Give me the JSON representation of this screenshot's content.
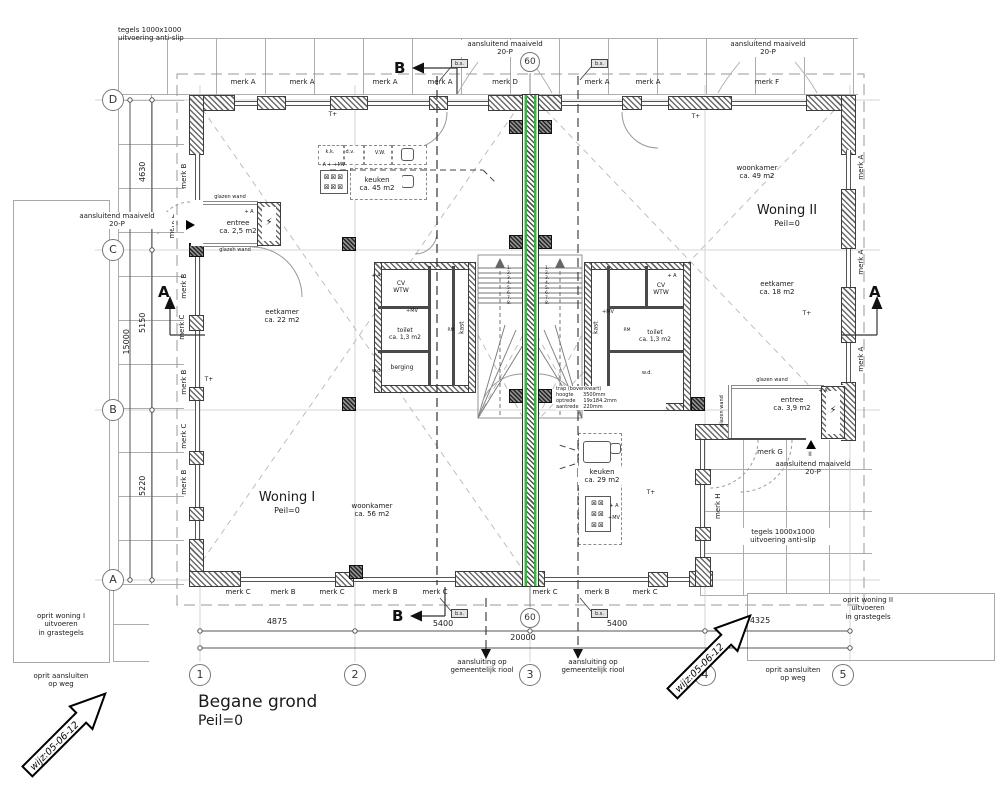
{
  "title": {
    "name": "Begane grond",
    "level": "Peil=0"
  },
  "grid": {
    "rows": [
      "D",
      "C",
      "B",
      "A"
    ],
    "cols": [
      "1",
      "2",
      "3",
      "4",
      "5"
    ],
    "bubble60": "60"
  },
  "dims": {
    "left": [
      "4630",
      "5150",
      "5220"
    ],
    "left_total": "15000",
    "bottom": [
      "4875",
      "5400",
      "5400",
      "4325"
    ],
    "bottom_total": "20000"
  },
  "marks": {
    "a": "merk A",
    "b": "merk B",
    "c": "merk C",
    "d": "merk D",
    "e": "merk E",
    "f": "merk F",
    "g": "merk G",
    "h": "merk H"
  },
  "sections": {
    "a": "A",
    "b": "B"
  },
  "units": {
    "woning1": {
      "name": "Woning I",
      "level": "Peil=0"
    },
    "woning2": {
      "name": "Woning II",
      "level": "Peil=0"
    }
  },
  "rooms": {
    "entree1": "entree\nca. 2,5 m2",
    "entree2": "entree\nca. 3,9 m2",
    "keuken1": "keuken\nca. 45 m2",
    "keuken2": "keuken\nca. 29 m2",
    "eetkamer1": "eetkamer\nca. 22 m2",
    "eetkamer2": "eetkamer\nca. 18 m2",
    "woonkamer1": "woonkamer\nca. 56 m2",
    "woonkamer2": "woonkamer\nca. 49 m2",
    "toilet1": "toilet\nca. 1,3 m2",
    "toilet2": "toilet\nca. 1,3 m2",
    "berging": "berging",
    "kast": "kast",
    "cv": "CV\nWTW"
  },
  "stair": {
    "note": "trap (bovenkwart)\nhoogte      3500mm\noptrede     19x184.2mm\naantrede   220mm",
    "treads": [
      "1.",
      "2.",
      "3.",
      "4.",
      "5.",
      "6.",
      "7.",
      "8."
    ]
  },
  "notes": {
    "tiles": "tegels 1000x1000\nuitvoering anti-slip",
    "maaiveld": "aansluitend maaiveld\n20-P",
    "riool": "aansluiting op\ngemeentelijk riool",
    "oprit1": "oprit woning I\nuitvoeren\nin grastegels",
    "oprit2": "oprit woning II\nuitvoeren\nin grastegels",
    "oprit_weg": "oprit aansluiten\nop weg",
    "wijz": "wijz:05-06-12",
    "glazen_wand": "glazen wand",
    "bs": "b.s."
  },
  "symbols": {
    "thermostat": "T+",
    "vent_a": "+ A",
    "vent_mv": "+MV",
    "vent_row": "A + +MV",
    "lightning": "⚡",
    "rm": "RM",
    "wd": "w.d.",
    "kk": "k.k.",
    "dv": "d.v.",
    "vw": "V.W.",
    "burners1": "⊠⊠⊠\n⊠⊠⊠",
    "burners2": "⊠⊠\n⊠⊠\n⊠⊠",
    "entrance1": "I",
    "entrance2": "II"
  }
}
